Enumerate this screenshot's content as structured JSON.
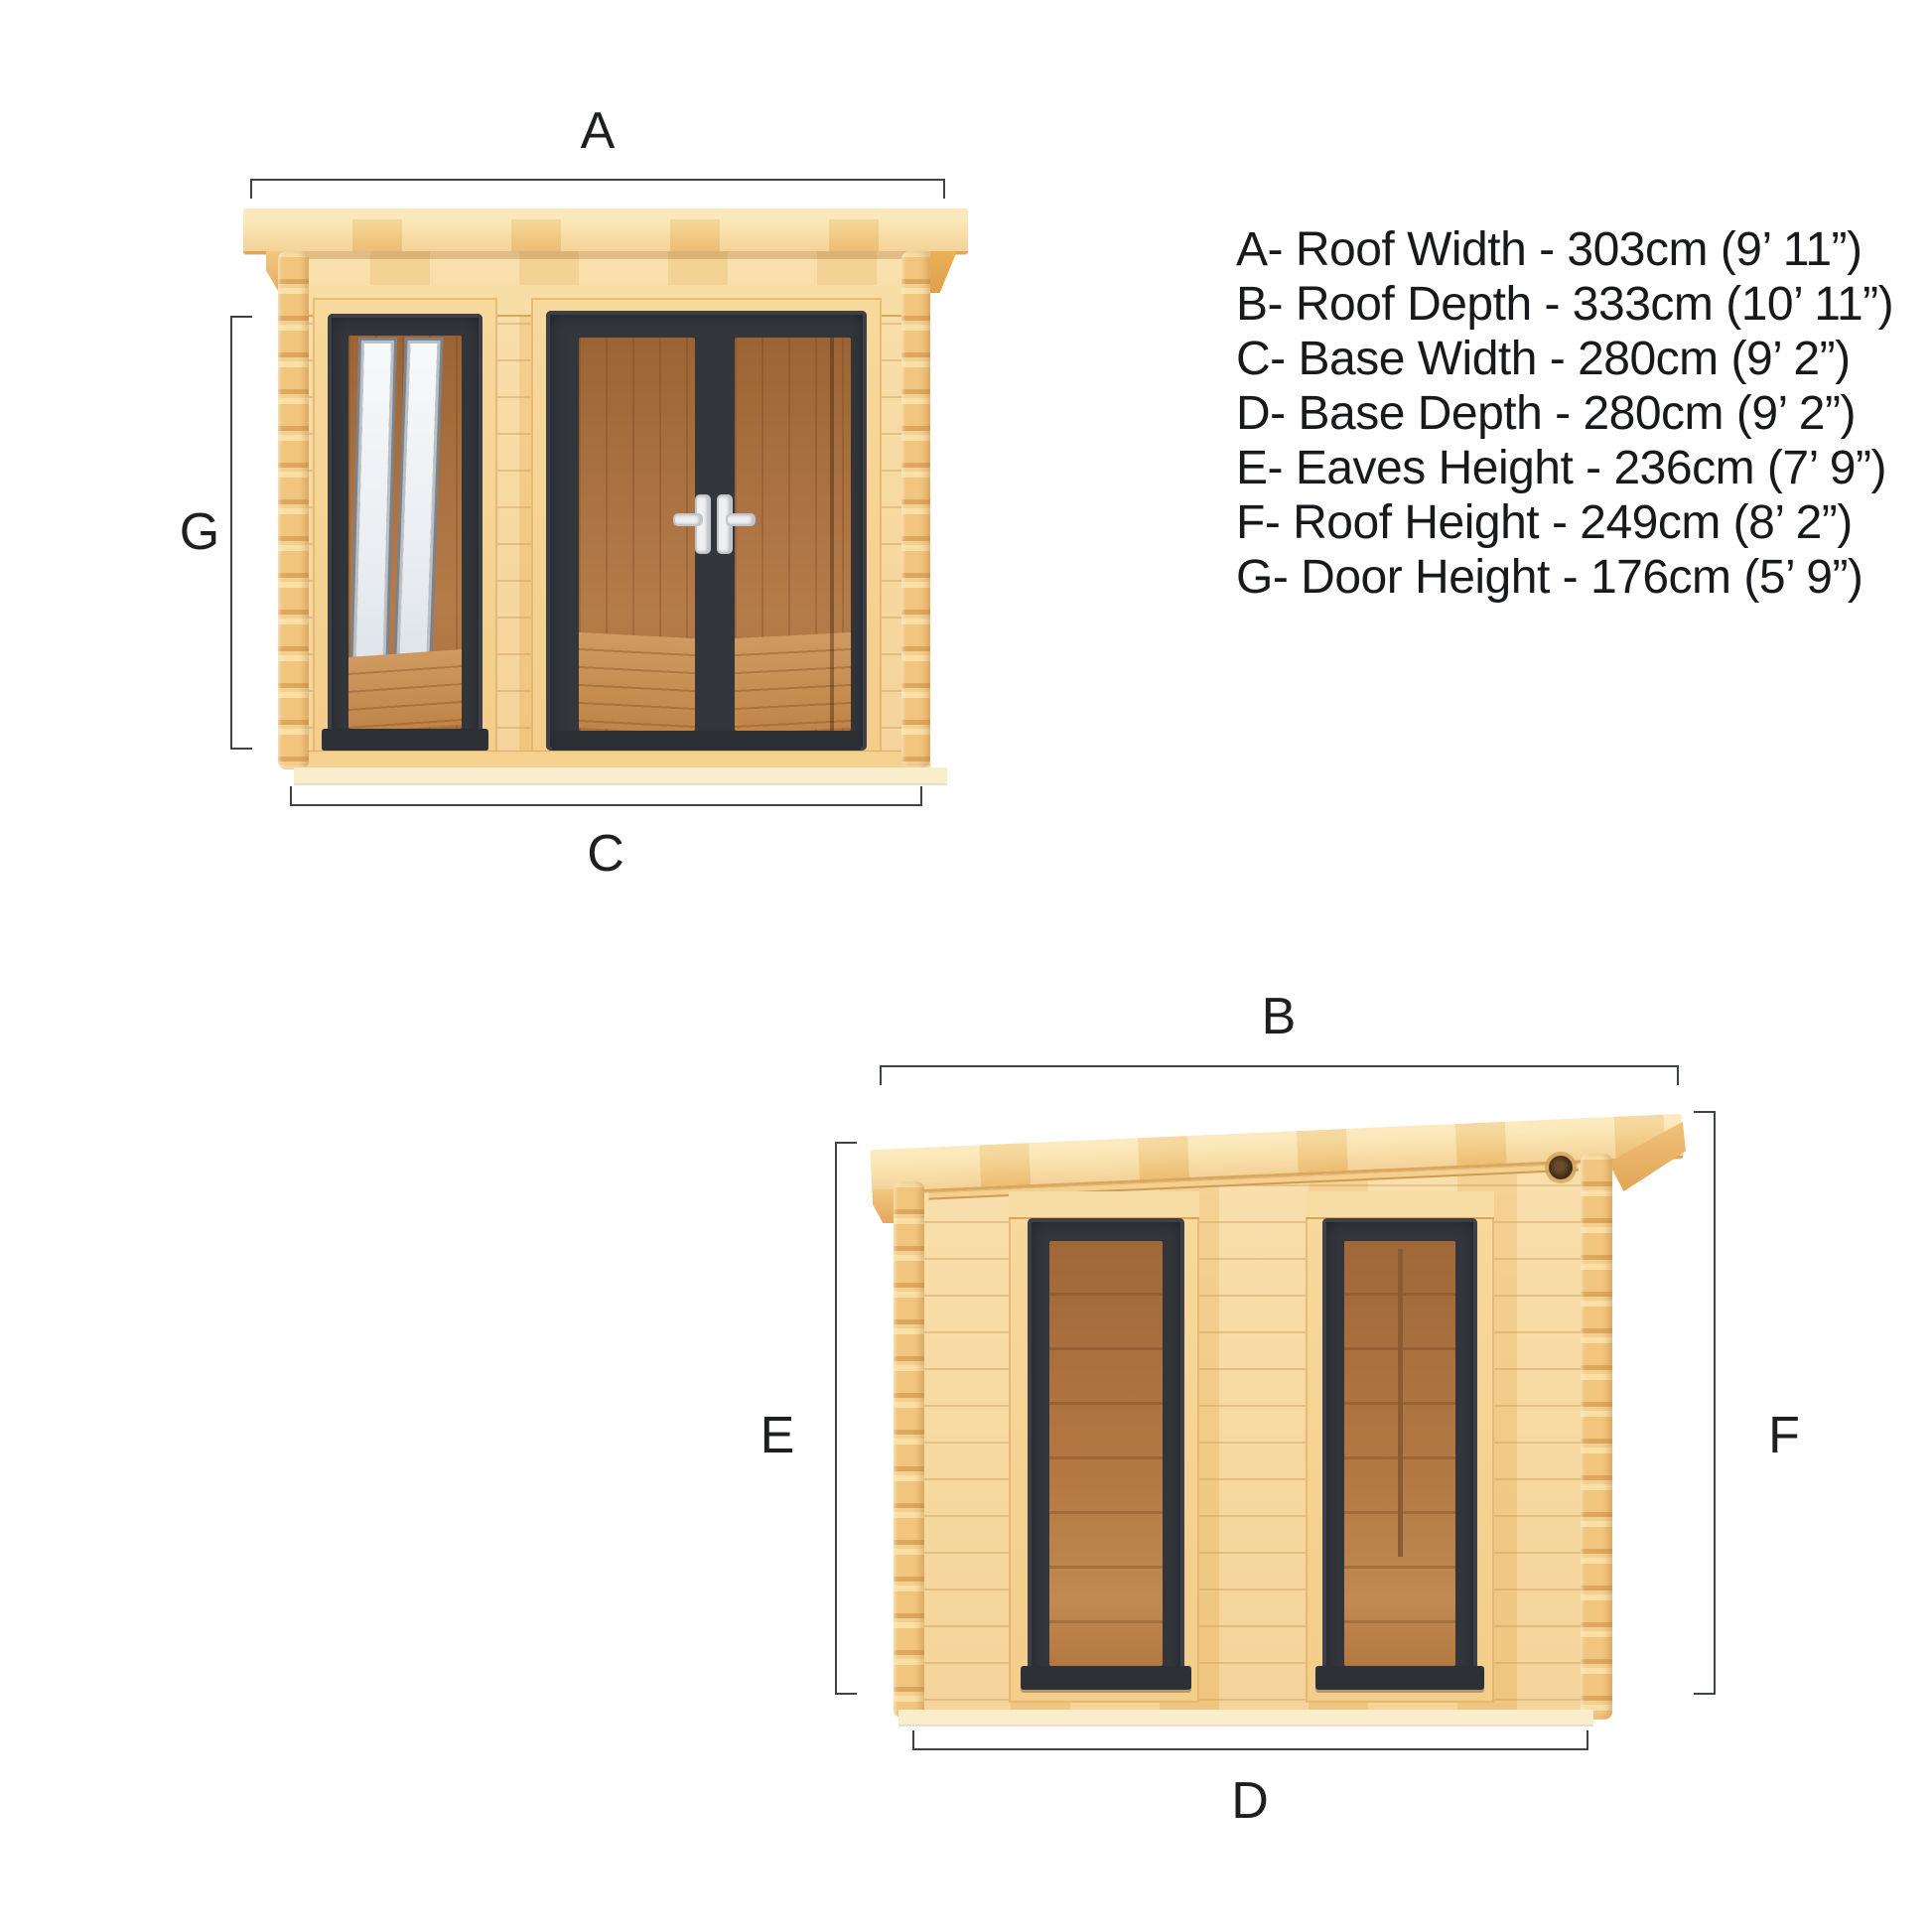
{
  "diagram": {
    "description": "Garden log cabin dimension diagram with front and side elevations",
    "colors": {
      "background": "#ffffff",
      "dimension_line": "#3f4246",
      "label_text": "#1d1f21",
      "pine_light": "#f8dfa8",
      "pine_mid": "#f3cd8a",
      "pine_edge": "#d9a85e",
      "frame_anthracite": "#33373c",
      "interior_wood": "#ad7343",
      "reflection_white": "#f7f9fb",
      "handle_white": "#eef0f2",
      "skid_pale": "#f9edcb"
    }
  },
  "legend": {
    "items": [
      {
        "text": "A- Roof Width - 303cm (9’ 11”)"
      },
      {
        "text": "B- Roof Depth - 333cm (10’ 11”)"
      },
      {
        "text": "C- Base Width - 280cm (9’ 2”)"
      },
      {
        "text": "D- Base Depth - 280cm (9’ 2”)"
      },
      {
        "text": "E- Eaves Height - 236cm (7’ 9”)"
      },
      {
        "text": "F- Roof Height - 249cm (8’ 2”)"
      },
      {
        "text": "G- Door Height - 176cm (5’ 9”)"
      }
    ]
  },
  "front_view": {
    "labels": {
      "roof_width": "A",
      "door_height": "G",
      "base_width": "C"
    }
  },
  "side_view": {
    "labels": {
      "roof_depth": "B",
      "eaves_height": "E",
      "roof_height": "F",
      "base_depth": "D"
    }
  }
}
